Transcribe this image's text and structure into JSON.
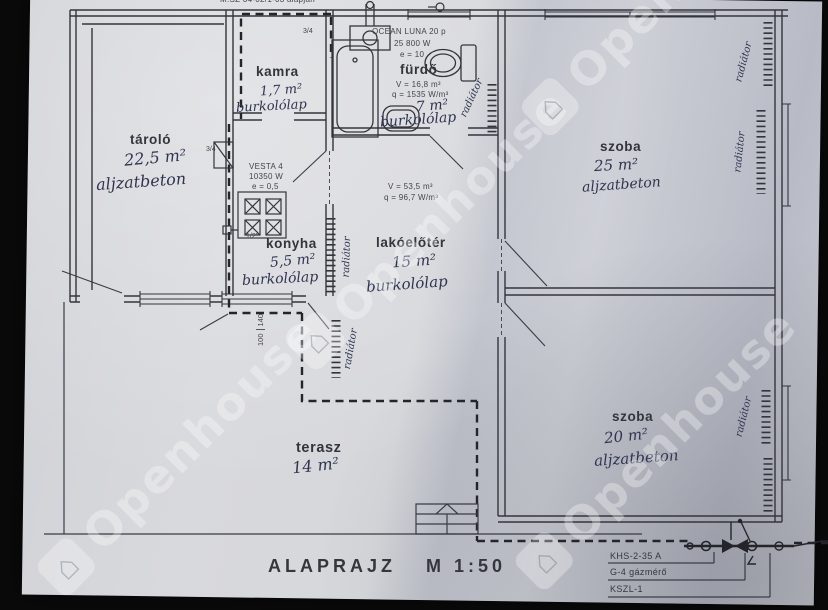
{
  "header": {
    "note": "M.SZ  04-02/1-03 alapján"
  },
  "title": {
    "main": "ALAPRAJZ",
    "scale": "M 1:50"
  },
  "watermark": {
    "text": "Openhouse",
    "logo": "⌂"
  },
  "boiler": {
    "model": "OCEAN LUNA 20 p",
    "power": "25 800 W",
    "factor": "e = 10"
  },
  "stove": {
    "model": "VESTA 4",
    "power": "10350 W",
    "factor": "e = 0,5"
  },
  "gas": {
    "item1": "KHS-2-35 A",
    "item2": "G-4 gázmérő",
    "item3": "KSZL-1"
  },
  "pipes": {
    "p34": "3/4",
    "p12": "1/2\"",
    "d100": "100",
    "d140": "140"
  },
  "labels": {
    "radiator": "radiátor"
  },
  "rooms": {
    "tarolo": {
      "name": "tároló",
      "area": "22,5 m²",
      "floor": "aljzatbeton"
    },
    "kamra": {
      "name": "kamra",
      "area": "1,7 m²",
      "floor": "burkolólap"
    },
    "furdo": {
      "name": "fürdő",
      "volume": "V = 16,8 m³",
      "load": "q = 1535 W/m³",
      "area": "7 m²",
      "floor": "burkolólap"
    },
    "konyha": {
      "name": "konyha",
      "area": "5,5 m²",
      "floor": "burkolólap"
    },
    "lakoeloter": {
      "name": "lakóelőtér",
      "volume": "V = 53,5 m³",
      "load": "q = 96,7 W/m³",
      "area": "15 m²",
      "floor": "burkolólap"
    },
    "szoba_felso": {
      "name": "szoba",
      "area": "25 m²",
      "floor": "aljzatbeton"
    },
    "szoba_also": {
      "name": "szoba",
      "area": "20 m²",
      "floor": "aljzatbeton"
    },
    "terasz": {
      "name": "terasz",
      "area": "14 m²"
    }
  },
  "colors": {
    "paper": "#d6d7db",
    "ink": "#34353c",
    "handwriting": "#2f3450",
    "background": "#0a0a0b"
  }
}
